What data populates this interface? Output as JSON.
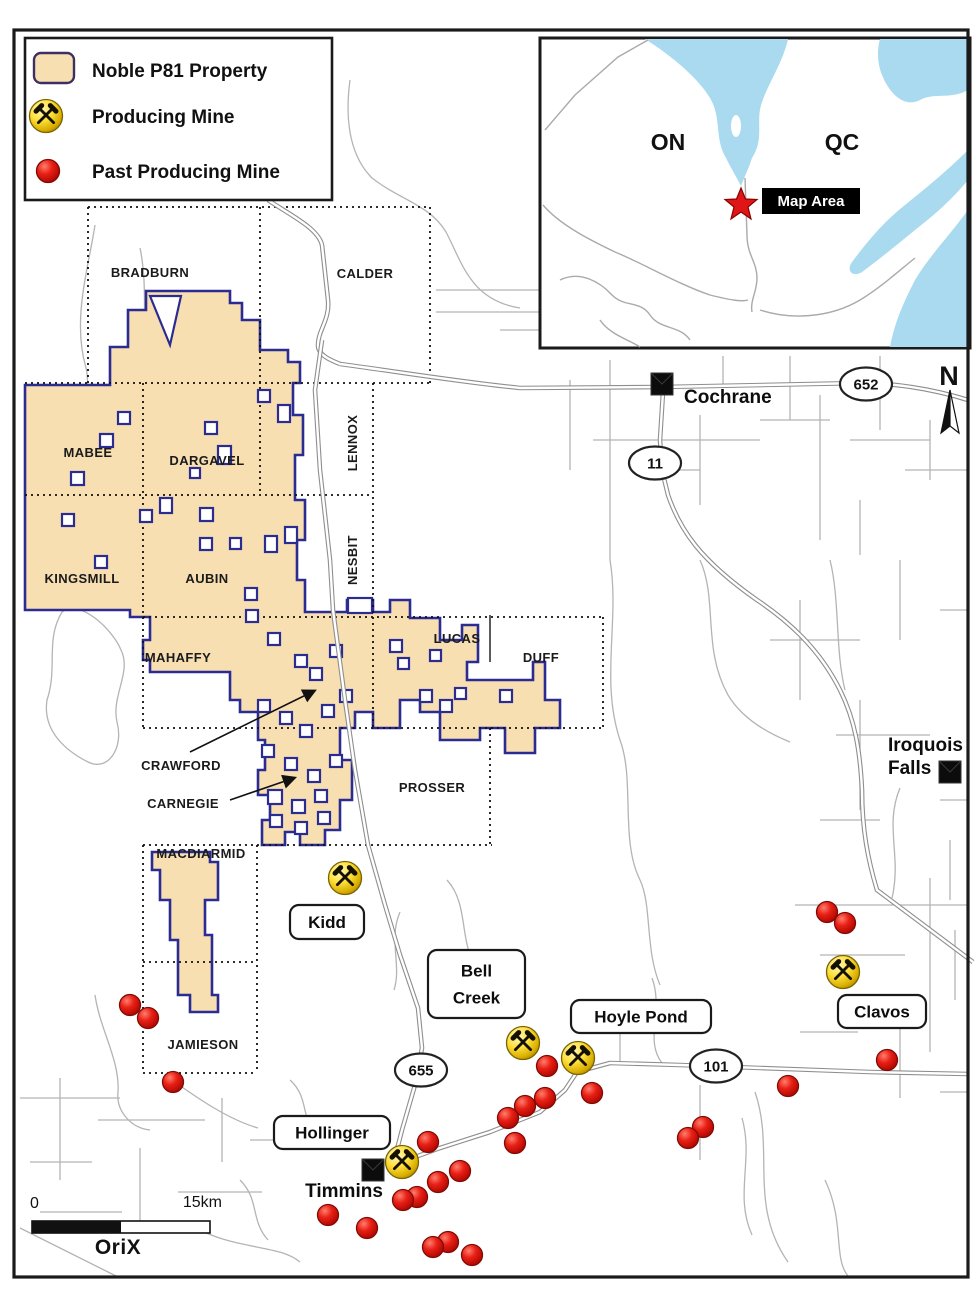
{
  "legend": {
    "items": [
      {
        "label": "Noble P81 Property",
        "symbol": "property-swatch"
      },
      {
        "label": "Producing Mine",
        "symbol": "producing-mine-icon"
      },
      {
        "label": "Past Producing Mine",
        "symbol": "past-producing-mine-icon"
      }
    ]
  },
  "inset": {
    "province_left": "ON",
    "province_right": "QC",
    "map_area_label": "Map Area"
  },
  "north_label": "N",
  "scale_bar": {
    "start": "0",
    "end": "15km"
  },
  "logo_text": "OriX",
  "townships": [
    {
      "name": "BRADBURN",
      "x": 150,
      "y": 277
    },
    {
      "name": "CALDER",
      "x": 365,
      "y": 278
    },
    {
      "name": "MABEE",
      "x": 88,
      "y": 457
    },
    {
      "name": "DARGAVEL",
      "x": 207,
      "y": 465
    },
    {
      "name": "LENNOX",
      "x": 357,
      "y": 443,
      "rotate": true
    },
    {
      "name": "KINGSMILL",
      "x": 82,
      "y": 583
    },
    {
      "name": "AUBIN",
      "x": 207,
      "y": 583
    },
    {
      "name": "NESBIT",
      "x": 357,
      "y": 560,
      "rotate": true
    },
    {
      "name": "MAHAFFY",
      "x": 178,
      "y": 662
    },
    {
      "name": "LUCAS",
      "x": 457,
      "y": 643
    },
    {
      "name": "DUFF",
      "x": 541,
      "y": 662
    },
    {
      "name": "CRAWFORD",
      "x": 181,
      "y": 770
    },
    {
      "name": "CARNEGIE",
      "x": 183,
      "y": 808
    },
    {
      "name": "PROSSER",
      "x": 432,
      "y": 792
    },
    {
      "name": "MACDIARMID",
      "x": 201,
      "y": 858
    },
    {
      "name": "JAMIESON",
      "x": 203,
      "y": 1049
    }
  ],
  "towns": [
    {
      "name": "Cochrane",
      "x": 662,
      "y": 384,
      "label": {
        "lines": [
          "Cochrane"
        ],
        "x": 684,
        "y": 403,
        "anchor": "start",
        "spacing": 23
      }
    },
    {
      "name": "Iroquois Falls",
      "x": 950,
      "y": 772,
      "label": {
        "lines": [
          "Iroquois",
          "Falls"
        ],
        "x": 888,
        "y": 751,
        "anchor": "start",
        "spacing": 23
      }
    },
    {
      "name": "Timmins",
      "x": 373,
      "y": 1170,
      "label": {
        "lines": [
          "Timmins"
        ],
        "x": 344,
        "y": 1197,
        "anchor": "middle",
        "spacing": 23
      }
    }
  ],
  "highways": [
    {
      "number": "652",
      "x": 866,
      "y": 384
    },
    {
      "number": "11",
      "x": 655,
      "y": 463
    },
    {
      "number": "655",
      "x": 421,
      "y": 1070
    },
    {
      "number": "101",
      "x": 716,
      "y": 1066
    }
  ],
  "producing_mines": [
    {
      "name": "Kidd",
      "x": 345,
      "y": 878,
      "label": {
        "x": 290,
        "y": 905,
        "w": 74,
        "h": 34,
        "lines": [
          "Kidd"
        ]
      }
    },
    {
      "name": "Bell Creek",
      "x": 523,
      "y": 1043,
      "label": {
        "x": 428,
        "y": 950,
        "w": 97,
        "h": 68,
        "lines": [
          "Bell",
          "Creek"
        ]
      }
    },
    {
      "name": "Hoyle Pond",
      "x": 578,
      "y": 1058,
      "label": {
        "x": 571,
        "y": 1000,
        "w": 140,
        "h": 33,
        "lines": [
          "Hoyle Pond"
        ]
      }
    },
    {
      "name": "Clavos",
      "x": 843,
      "y": 972,
      "label": {
        "x": 838,
        "y": 995,
        "w": 88,
        "h": 33,
        "lines": [
          "Clavos"
        ]
      }
    },
    {
      "name": "Hollinger",
      "x": 402,
      "y": 1162,
      "label": {
        "x": 274,
        "y": 1116,
        "w": 116,
        "h": 33,
        "lines": [
          "Hollinger"
        ]
      }
    }
  ],
  "past_producing_mines": [
    [
      130,
      1005
    ],
    [
      148,
      1018
    ],
    [
      173,
      1082
    ],
    [
      827,
      912
    ],
    [
      845,
      923
    ],
    [
      887,
      1060
    ],
    [
      788,
      1086
    ],
    [
      547,
      1066
    ],
    [
      592,
      1093
    ],
    [
      545,
      1098
    ],
    [
      525,
      1106
    ],
    [
      508,
      1118
    ],
    [
      428,
      1142
    ],
    [
      515,
      1143
    ],
    [
      460,
      1171
    ],
    [
      438,
      1182
    ],
    [
      417,
      1197
    ],
    [
      403,
      1200
    ],
    [
      328,
      1215
    ],
    [
      367,
      1228
    ],
    [
      448,
      1242
    ],
    [
      433,
      1247
    ],
    [
      472,
      1255
    ],
    [
      703,
      1127
    ],
    [
      688,
      1138
    ]
  ],
  "colors": {
    "property_fill": "#F8DFB2",
    "property_border": "#2B2C91",
    "producing_mine_yellow": "#F5D400",
    "past_mine_red": "#E32017",
    "inset_water": "#A9DAEF",
    "map_area_bg": "#000000",
    "star_red": "#E01616"
  }
}
